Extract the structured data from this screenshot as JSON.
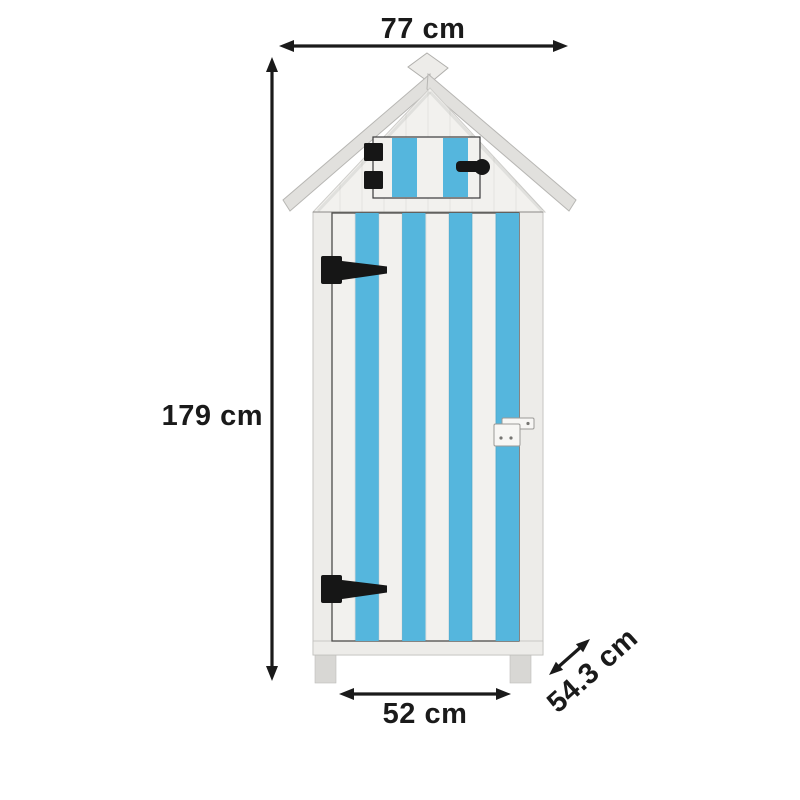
{
  "diagram": {
    "subject": "striped beach-hut style wooden storage cabinet with dimension annotations"
  },
  "dimensions": {
    "width": {
      "label": "77 cm"
    },
    "height": {
      "label": "179 cm"
    },
    "door_width": {
      "label": "52 cm"
    },
    "depth": {
      "label": "54.3 cm"
    }
  },
  "colors": {
    "background": "#ffffff",
    "stripe_blue": "#55b6dd",
    "panel_white": "#f2f1ee",
    "frame_white": "#edece9",
    "roof_gray": "#e1e0dd",
    "roof_edge": "#b7b6b3",
    "leg_gray": "#d8d7d4",
    "hardware_black": "#161616",
    "latch_white": "#f7f6f4",
    "door_outline": "#4d4c4a",
    "outline_gray": "#b0afac",
    "annotation_black": "#1a1a1a"
  }
}
